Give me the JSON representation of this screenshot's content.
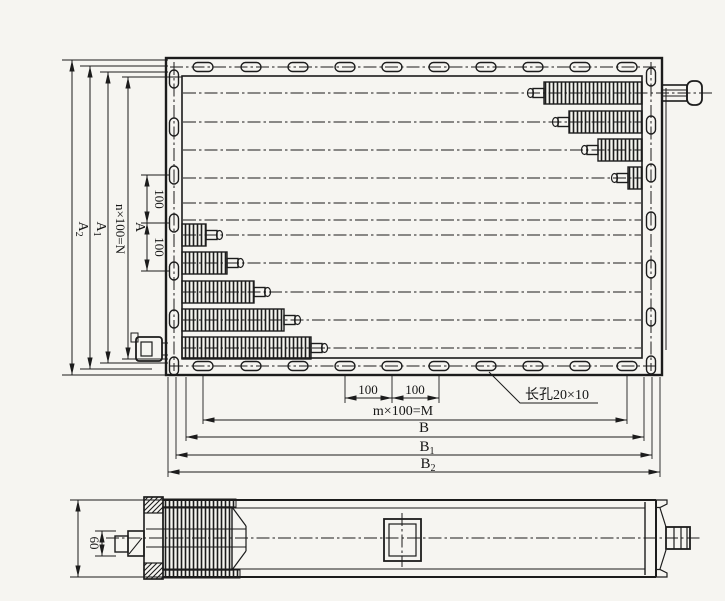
{
  "labels": {
    "a2": {
      "base": "A",
      "sub": "2"
    },
    "a1": {
      "base": "A",
      "sub": "1"
    },
    "n100": "n×100=N",
    "a": "A",
    "pitch100_upper": "100",
    "pitch100_lower": "100",
    "bottom100_left": "100",
    "bottom100_right": "100",
    "m100": "m×100=M",
    "b": "B",
    "b1": {
      "base": "B",
      "sub": "1"
    },
    "b2": {
      "base": "B",
      "sub": "2"
    },
    "slot_note": "长孔20×10",
    "height60": "60"
  },
  "colors": {
    "ink": "#1c1c1c",
    "paper": "#f6f5f1"
  },
  "geometry": {
    "rows_x1": 183,
    "rows_x2": 641,
    "row0_x2": 712,
    "rows_y": [
      93,
      122,
      150,
      178,
      203,
      220,
      235,
      263,
      292,
      320,
      348
    ],
    "slot_cols_x": [
      203,
      251,
      298,
      345,
      392,
      439,
      486,
      533,
      580,
      627
    ],
    "slot_top_cy": 67,
    "slot_bottom_cy": 366,
    "left_slot_cx": 174,
    "left_slot_rows_y": [
      79,
      127,
      175,
      223,
      271,
      319,
      366
    ],
    "right_slot_cx": 651,
    "right_slot_rows_y": [
      77,
      125,
      173,
      221,
      269,
      317,
      365
    ],
    "right_attach_x": 642,
    "left_attach_x": 182,
    "right_elements": [
      {
        "y": 93,
        "tip_x": 528
      },
      {
        "y": 122,
        "tip_x": 553
      },
      {
        "y": 150,
        "tip_x": 582
      },
      {
        "y": 178,
        "tip_x": 612
      }
    ],
    "left_elements": [
      {
        "y": 235,
        "tip_x": 222
      },
      {
        "y": 263,
        "tip_x": 243
      },
      {
        "y": 292,
        "tip_x": 270
      },
      {
        "y": 320,
        "tip_x": 300
      },
      {
        "y": 348,
        "tip_x": 327
      }
    ]
  }
}
